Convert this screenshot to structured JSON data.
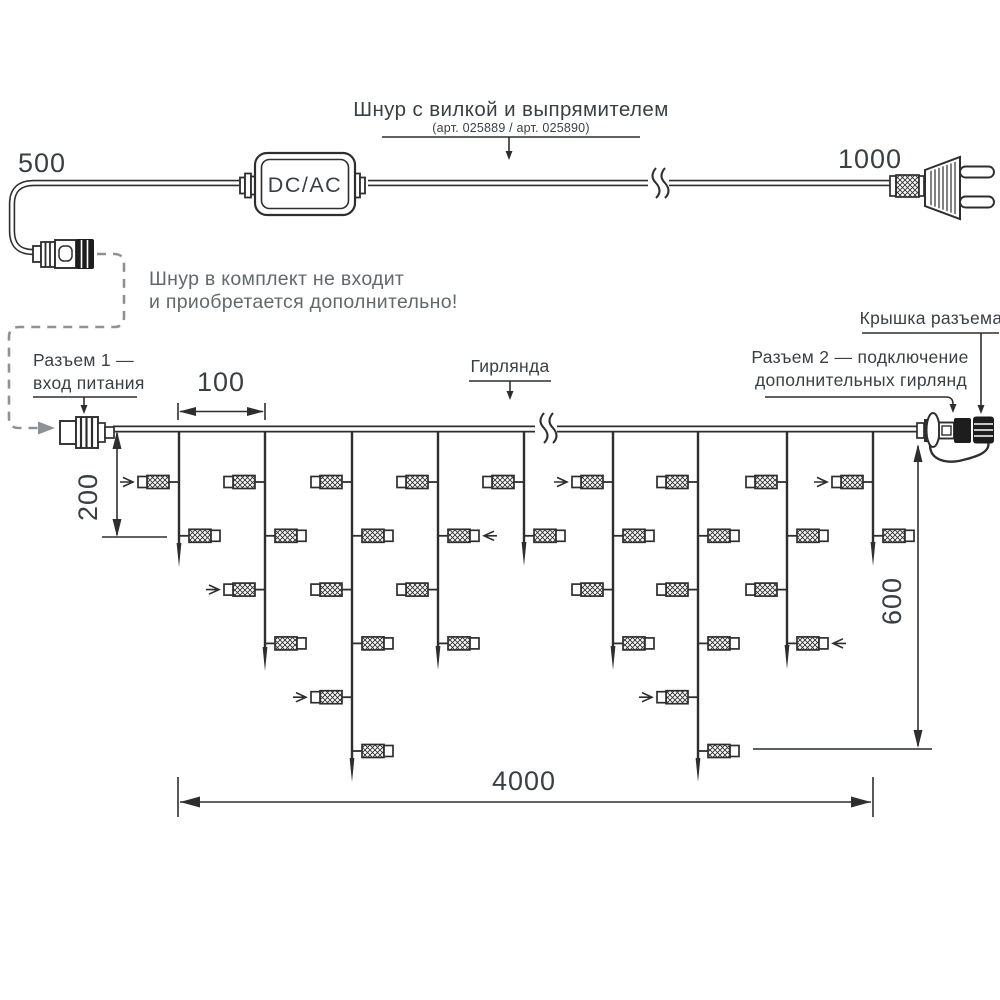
{
  "colors": {
    "line": "#2e2e2e",
    "text": "#3a3f44",
    "gray_text": "#63686c",
    "dashed": "#8e9296"
  },
  "cord": {
    "title": "Шнур с вилкой и выпрямителем",
    "subtitle": "(арт. 025889 / арт. 025890)",
    "converter_label": "DC/AC",
    "dim_left": "500",
    "dim_right": "1000"
  },
  "note": {
    "line1": "Шнур в комплект не входит",
    "line2": "и приобретается дополнительно!"
  },
  "callouts": {
    "connector1_line1": "Разъем 1 —",
    "connector1_line2": "вход питания",
    "garland": "Гирлянда",
    "connector2_line1": "Разъем 2 — подключение",
    "connector2_line2": "дополнительных гирлянд",
    "cap": "Крышка разъема"
  },
  "dimensions": {
    "spacing": "100",
    "drop_min": "200",
    "drop_max": "600",
    "length": "4000"
  },
  "garland": {
    "wire_y": 429,
    "x_start": 113,
    "x_end": 917,
    "level_y": [
      482,
      535.8,
      589.6,
      643.4,
      697.2,
      751
    ],
    "strands": [
      {
        "x": 179,
        "tip": 567,
        "bulbs": [
          {
            "level": 0,
            "side": "left",
            "arrow": true
          },
          {
            "level": 1,
            "side": "right",
            "arrow": false
          }
        ]
      },
      {
        "x": 265,
        "tip": 671,
        "bulbs": [
          {
            "level": 0,
            "side": "left",
            "arrow": false
          },
          {
            "level": 1,
            "side": "right",
            "arrow": false
          },
          {
            "level": 2,
            "side": "left",
            "arrow": true
          },
          {
            "level": 3,
            "side": "right",
            "arrow": false
          }
        ]
      },
      {
        "x": 352,
        "tip": 782,
        "bulbs": [
          {
            "level": 0,
            "side": "left",
            "arrow": false
          },
          {
            "level": 1,
            "side": "right",
            "arrow": false
          },
          {
            "level": 2,
            "side": "left",
            "arrow": false
          },
          {
            "level": 3,
            "side": "right",
            "arrow": false
          },
          {
            "level": 4,
            "side": "left",
            "arrow": true
          },
          {
            "level": 5,
            "side": "right",
            "arrow": false
          }
        ]
      },
      {
        "x": 438,
        "tip": 670,
        "bulbs": [
          {
            "level": 0,
            "side": "left",
            "arrow": false
          },
          {
            "level": 1,
            "side": "right",
            "arrow": true
          },
          {
            "level": 2,
            "side": "left",
            "arrow": false
          },
          {
            "level": 3,
            "side": "right",
            "arrow": false
          }
        ]
      },
      {
        "x": 524,
        "tip": 566,
        "bulbs": [
          {
            "level": 0,
            "side": "left",
            "arrow": false
          },
          {
            "level": 1,
            "side": "right",
            "arrow": false
          }
        ]
      },
      {
        "x": 613,
        "tip": 670,
        "bulbs": [
          {
            "level": 0,
            "side": "left",
            "arrow": true
          },
          {
            "level": 1,
            "side": "right",
            "arrow": false
          },
          {
            "level": 2,
            "side": "left",
            "arrow": false
          },
          {
            "level": 3,
            "side": "right",
            "arrow": false
          }
        ]
      },
      {
        "x": 698,
        "tip": 782,
        "bulbs": [
          {
            "level": 0,
            "side": "left",
            "arrow": false
          },
          {
            "level": 1,
            "side": "right",
            "arrow": false
          },
          {
            "level": 2,
            "side": "left",
            "arrow": false
          },
          {
            "level": 3,
            "side": "right",
            "arrow": false
          },
          {
            "level": 4,
            "side": "left",
            "arrow": true
          },
          {
            "level": 5,
            "side": "right",
            "arrow": false
          }
        ]
      },
      {
        "x": 787,
        "tip": 669,
        "bulbs": [
          {
            "level": 0,
            "side": "left",
            "arrow": false
          },
          {
            "level": 1,
            "side": "right",
            "arrow": false
          },
          {
            "level": 2,
            "side": "left",
            "arrow": false
          },
          {
            "level": 3,
            "side": "right",
            "arrow": true
          }
        ]
      },
      {
        "x": 873,
        "tip": 566,
        "bulbs": [
          {
            "level": 0,
            "side": "left",
            "arrow": true
          },
          {
            "level": 1,
            "side": "right",
            "arrow": false
          }
        ]
      }
    ]
  }
}
